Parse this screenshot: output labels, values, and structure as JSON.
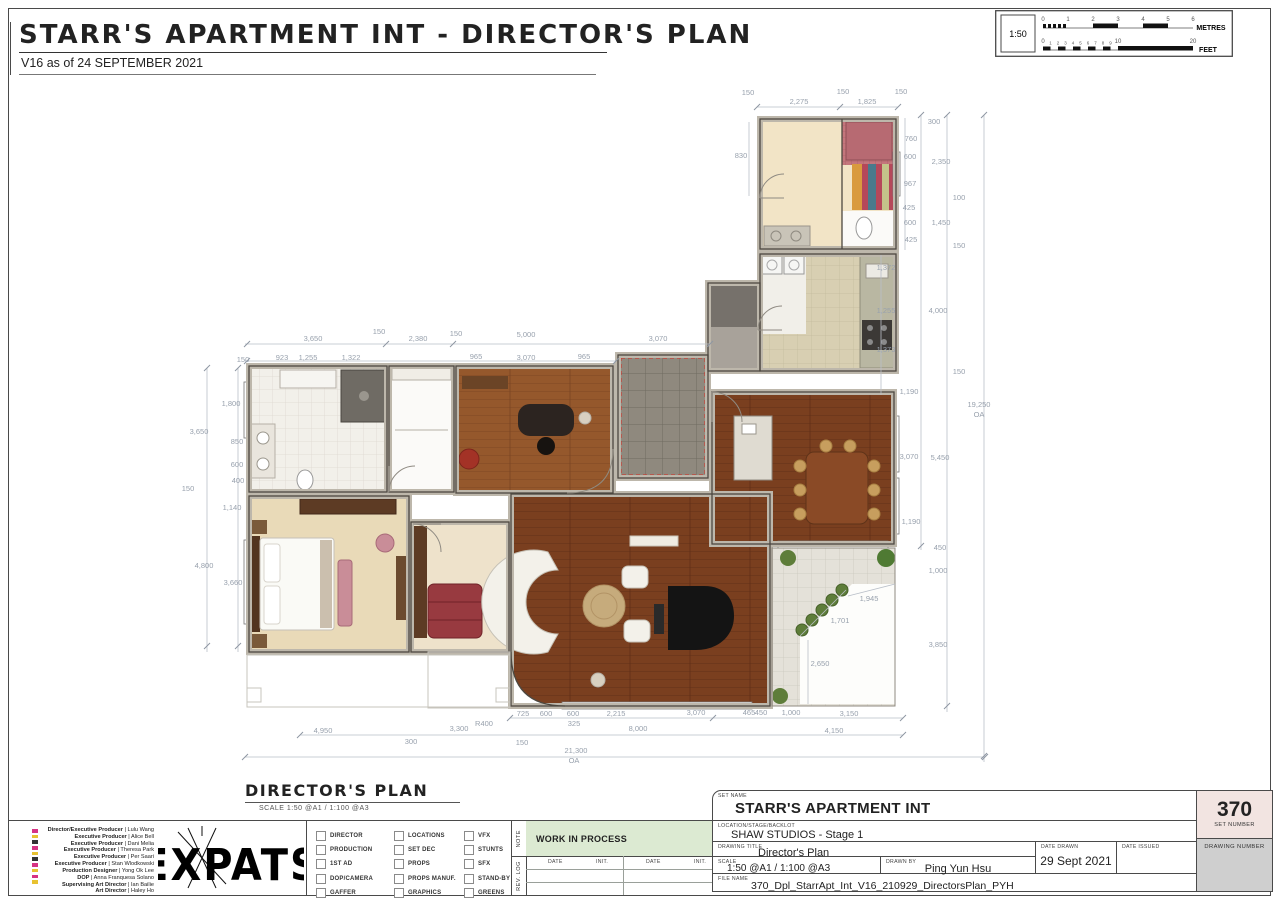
{
  "header": {
    "title": "STARR'S APARTMENT INT - DIRECTOR'S PLAN",
    "version": "V16 as of 24 SEPTEMBER 2021"
  },
  "scale_bar": {
    "ratio": "1:50",
    "metres_label": "METRES",
    "feet_label": "FEET",
    "metre_ticks": [
      "0",
      "1",
      "2",
      "3",
      "4",
      "5",
      "6"
    ],
    "feet_major_ticks": [
      "0",
      "10",
      "20"
    ],
    "feet_minor_ticks": [
      "1",
      "2",
      "3",
      "4",
      "5",
      "6",
      "7",
      "8",
      "9"
    ]
  },
  "plan_caption": {
    "label": "DIRECTOR'S PLAN",
    "scale_note": "SCALE 1:50 @A1 / 1:100 @A3"
  },
  "plan": {
    "overall_width": "21,300 OA",
    "overall_height": "19,250 OA",
    "dimensions": [
      {
        "t": "150",
        "x": 748,
        "y": 95
      },
      {
        "t": "2,275",
        "x": 799,
        "y": 104
      },
      {
        "t": "150",
        "x": 843,
        "y": 94
      },
      {
        "t": "1,825",
        "x": 867,
        "y": 104
      },
      {
        "t": "150",
        "x": 901,
        "y": 94
      },
      {
        "t": "830",
        "x": 741,
        "y": 158
      },
      {
        "t": "300",
        "x": 934,
        "y": 124
      },
      {
        "t": "760",
        "x": 911,
        "y": 141
      },
      {
        "t": "600",
        "x": 910,
        "y": 159
      },
      {
        "t": "2,350",
        "x": 941,
        "y": 164
      },
      {
        "t": "967",
        "x": 910,
        "y": 186
      },
      {
        "t": "100",
        "x": 959,
        "y": 200
      },
      {
        "t": "425",
        "x": 909,
        "y": 210
      },
      {
        "t": "600",
        "x": 910,
        "y": 225
      },
      {
        "t": "1,450",
        "x": 941,
        "y": 225
      },
      {
        "t": "425",
        "x": 911,
        "y": 242
      },
      {
        "t": "150",
        "x": 959,
        "y": 248
      },
      {
        "t": "1,372",
        "x": 886,
        "y": 270
      },
      {
        "t": "1,255",
        "x": 886,
        "y": 313
      },
      {
        "t": "4,000",
        "x": 938,
        "y": 313
      },
      {
        "t": "1,373",
        "x": 886,
        "y": 352
      },
      {
        "t": "150",
        "x": 959,
        "y": 374
      },
      {
        "t": "1,190",
        "x": 909,
        "y": 394
      },
      {
        "t": "19,250",
        "x": 979,
        "y": 407
      },
      {
        "t": "OA",
        "x": 979,
        "y": 417
      },
      {
        "t": "3,070",
        "x": 909,
        "y": 459
      },
      {
        "t": "5,450",
        "x": 940,
        "y": 460
      },
      {
        "t": "1,190",
        "x": 911,
        "y": 524
      },
      {
        "t": "450",
        "x": 940,
        "y": 550
      },
      {
        "t": "1,000",
        "x": 938,
        "y": 573
      },
      {
        "t": "3,850",
        "x": 938,
        "y": 647
      },
      {
        "t": "1,945",
        "x": 869,
        "y": 601
      },
      {
        "t": "1,701",
        "x": 840,
        "y": 623
      },
      {
        "t": "2,650",
        "x": 820,
        "y": 666
      },
      {
        "t": "150",
        "x": 243,
        "y": 362
      },
      {
        "t": "1,800",
        "x": 231,
        "y": 406
      },
      {
        "t": "3,650",
        "x": 199,
        "y": 434
      },
      {
        "t": "850",
        "x": 237,
        "y": 444
      },
      {
        "t": "600",
        "x": 237,
        "y": 467
      },
      {
        "t": "400",
        "x": 238,
        "y": 483
      },
      {
        "t": "150",
        "x": 188,
        "y": 491
      },
      {
        "t": "1,140",
        "x": 232,
        "y": 510
      },
      {
        "t": "4,800",
        "x": 204,
        "y": 568
      },
      {
        "t": "3,660",
        "x": 233,
        "y": 585
      },
      {
        "t": "3,650",
        "x": 313,
        "y": 341
      },
      {
        "t": "150",
        "x": 379,
        "y": 334
      },
      {
        "t": "2,380",
        "x": 418,
        "y": 341
      },
      {
        "t": "150",
        "x": 456,
        "y": 336
      },
      {
        "t": "923",
        "x": 282,
        "y": 360
      },
      {
        "t": "1,255",
        "x": 308,
        "y": 360
      },
      {
        "t": "1,322",
        "x": 351,
        "y": 360
      },
      {
        "t": "965",
        "x": 476,
        "y": 359
      },
      {
        "t": "5,000",
        "x": 526,
        "y": 337
      },
      {
        "t": "3,070",
        "x": 526,
        "y": 360
      },
      {
        "t": "965",
        "x": 584,
        "y": 359
      },
      {
        "t": "3,070",
        "x": 658,
        "y": 341
      },
      {
        "t": "725",
        "x": 523,
        "y": 716
      },
      {
        "t": "600",
        "x": 546,
        "y": 716
      },
      {
        "t": "600",
        "x": 573,
        "y": 716
      },
      {
        "t": "325",
        "x": 574,
        "y": 726
      },
      {
        "t": "2,215",
        "x": 616,
        "y": 716
      },
      {
        "t": "R400",
        "x": 484,
        "y": 726
      },
      {
        "t": "3,300",
        "x": 459,
        "y": 731
      },
      {
        "t": "8,000",
        "x": 638,
        "y": 731
      },
      {
        "t": "150",
        "x": 522,
        "y": 745
      },
      {
        "t": "21,300",
        "x": 576,
        "y": 753
      },
      {
        "t": "OA",
        "x": 574,
        "y": 763
      },
      {
        "t": "3,070",
        "x": 696,
        "y": 715
      },
      {
        "t": "465",
        "x": 749,
        "y": 715
      },
      {
        "t": "450",
        "x": 761,
        "y": 715
      },
      {
        "t": "1,000",
        "x": 791,
        "y": 715
      },
      {
        "t": "3,150",
        "x": 849,
        "y": 716
      },
      {
        "t": "4,150",
        "x": 834,
        "y": 733
      },
      {
        "t": "4,950",
        "x": 323,
        "y": 733
      },
      {
        "t": "300",
        "x": 411,
        "y": 744
      }
    ]
  },
  "credits": [
    "Director/Executive Producer | Lulu Wang",
    "Executive Producer | Alice Bell",
    "Executive Producer | Dani Melia",
    "Executive Producer | Theresa Park",
    "Executive Producer | Per Saari",
    "Executive Producer | Stan Wlodkowski",
    "Production Designer | Yong Ok Lee",
    "DOP | Anna Franquesa Solano",
    "Supervising Art Director | Ian Bailie",
    "Art Director | Haley Ho"
  ],
  "logo_text": "EXPATS",
  "distribution": {
    "columns": [
      [
        "DIRECTOR",
        "PRODUCTION",
        "1ST AD",
        "DOP/CAMERA",
        "GAFFER"
      ],
      [
        "LOCATIONS",
        "SET DEC",
        "PROPS",
        "PROPS MANUF.",
        "GRAPHICS"
      ],
      [
        "VFX",
        "STUNTS",
        "SFX",
        "STAND-BY",
        "GREENS"
      ]
    ]
  },
  "note": {
    "label": "NOTE",
    "value": "WORK IN PROCESS"
  },
  "rev_log": {
    "label": "REV. LOG",
    "headers": [
      "DATE",
      "INIT.",
      "DATE",
      "INIT."
    ]
  },
  "title_block": {
    "set_name_label": "SET NAME",
    "set_name": "STARR'S APARTMENT INT",
    "location_label": "LOCATION/STAGE/BACKLOT",
    "location": "SHAW STUDIOS - Stage 1",
    "drawing_title_label": "DRAWING TITLE",
    "drawing_title": "Director's Plan",
    "scale_label": "SCALE",
    "scale": "1:50 @A1 / 1:100 @A3",
    "drawn_by_label": "DRAWN BY",
    "drawn_by": "Ping Yun Hsu",
    "date_drawn_label": "DATE DRAWN",
    "date_drawn": "29 Sept 2021",
    "date_issued_label": "DATE ISSUED",
    "date_issued": "",
    "file_name_label": "FILE NAME",
    "file_name": "370_Dpl_StarrApt_Int_V16_210929_DirectorsPlan_PYH",
    "set_number": "370",
    "set_number_label": "SET NUMBER",
    "drawing_number_label": "DRAWING NUMBER"
  },
  "colors": {
    "note_green": "#dcead2",
    "set_number_bg": "#f2e4e1",
    "drawing_number_bg": "#cfcfcf",
    "dimension_text": "#98a1ad",
    "wood_floor": "#7a3f1f",
    "safety_red": "#cc3b33"
  }
}
